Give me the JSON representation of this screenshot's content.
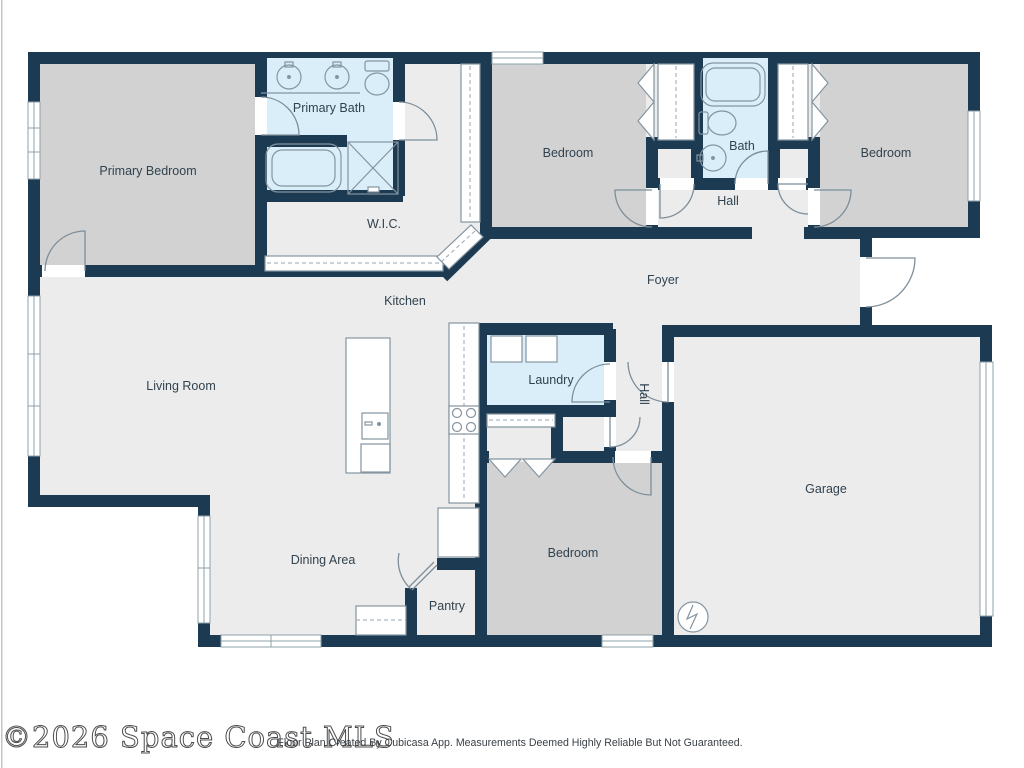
{
  "document": {
    "watermark": "©2026 Space Coast MLS",
    "disclaimer": "Floor Plan Created By Cubicasa App. Measurements Deemed Highly Reliable But Not Guaranteed."
  },
  "floorplan": {
    "rooms": [
      {
        "id": "primary-bedroom",
        "label": "Primary Bedroom"
      },
      {
        "id": "primary-bath",
        "label": "Primary Bath"
      },
      {
        "id": "wic",
        "label": "W.I.C."
      },
      {
        "id": "bedroom-top-middle",
        "label": "Bedroom"
      },
      {
        "id": "bath",
        "label": "Bath"
      },
      {
        "id": "bedroom-top-right",
        "label": "Bedroom"
      },
      {
        "id": "hall-upper",
        "label": "Hall"
      },
      {
        "id": "foyer",
        "label": "Foyer"
      },
      {
        "id": "kitchen",
        "label": "Kitchen"
      },
      {
        "id": "living-room",
        "label": "Living Room"
      },
      {
        "id": "laundry",
        "label": "Laundry"
      },
      {
        "id": "hall-lower",
        "label": "Hall"
      },
      {
        "id": "garage",
        "label": "Garage"
      },
      {
        "id": "dining-area",
        "label": "Dining Area"
      },
      {
        "id": "bedroom-bottom",
        "label": "Bedroom"
      },
      {
        "id": "pantry",
        "label": "Pantry"
      }
    ],
    "colors": {
      "wall": "#1c3a52",
      "floor": "#ececec",
      "bedroom_fill": "#d2d2d2",
      "wet_room_fill": "#d9eef8",
      "fixture_line": "#8494a0",
      "label_text": "#31424f"
    },
    "fixtures": [
      "double-vanity-sinks",
      "toilets",
      "bathtubs",
      "shower",
      "wardrobes",
      "washer-dryer",
      "kitchen-island-with-sink",
      "stove-cooktop",
      "refrigerator",
      "counters",
      "water-heater",
      "garage-door",
      "windows",
      "hinged-doors",
      "bifold-doors"
    ]
  }
}
